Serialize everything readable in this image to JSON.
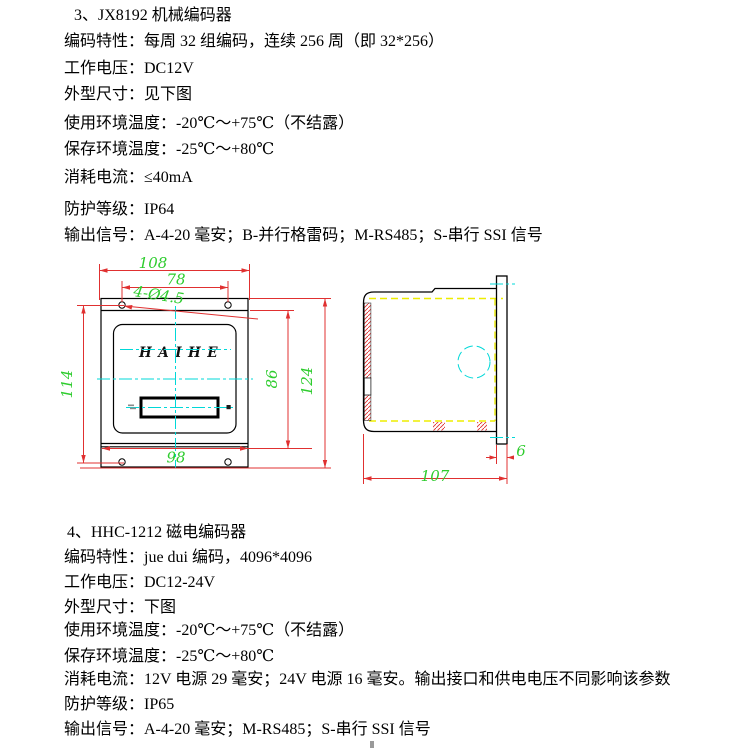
{
  "colors": {
    "dimension_red": "#e03030",
    "dimension_green": "#2ecc2e",
    "centerline_cyan": "#00d8d8",
    "hidden_line_yellow": "#eded00",
    "outline_black": "#000000",
    "body_text": "#000000"
  },
  "sections": [
    {
      "heading": "3、JX8192 机械编码器",
      "lines": [
        "编码特性：每周 32 组编码，连续 256 周（即 32*256）",
        "工作电压：DC12V",
        "外型尺寸：见下图",
        "使用环境温度：-20℃～+75℃（不结露）",
        "保存环境温度：-25℃～+80℃",
        "消耗电流：≤40mA",
        "防护等级：IP64",
        "输出信号：A-4-20 毫安；B-并行格雷码；M-RS485；S-串行 SSI 信号"
      ]
    },
    {
      "heading": "4、HHC-1212 磁电编码器",
      "lines": [
        "编码特性：jue dui 编码，4096*4096",
        "工作电压：DC12-24V",
        "外型尺寸：下图",
        "使用环境温度：-20℃～+75℃（不结露）",
        "保存环境温度：-25℃～+80℃",
        "消耗电流：12V 电源 29 毫安；24V 电源 16 毫安。输出接口和供电电压不同影响该参数",
        "防护等级：IP65",
        "输出信号：A-4-20 毫安；M-RS485；S-串行 SSI 信号"
      ]
    }
  ],
  "drawing": {
    "front_view": {
      "brand": "HAIHE",
      "dim_top_width": "108",
      "dim_hole_span_h": "78",
      "dim_hole_span_v": "114",
      "dim_body_height": "86",
      "dim_outer_height": "124",
      "dim_bottom_width": "98",
      "hole_callout": "4-Ø4.5"
    },
    "side_view": {
      "dim_depth": "107",
      "dim_flange_thickness": "6"
    }
  }
}
